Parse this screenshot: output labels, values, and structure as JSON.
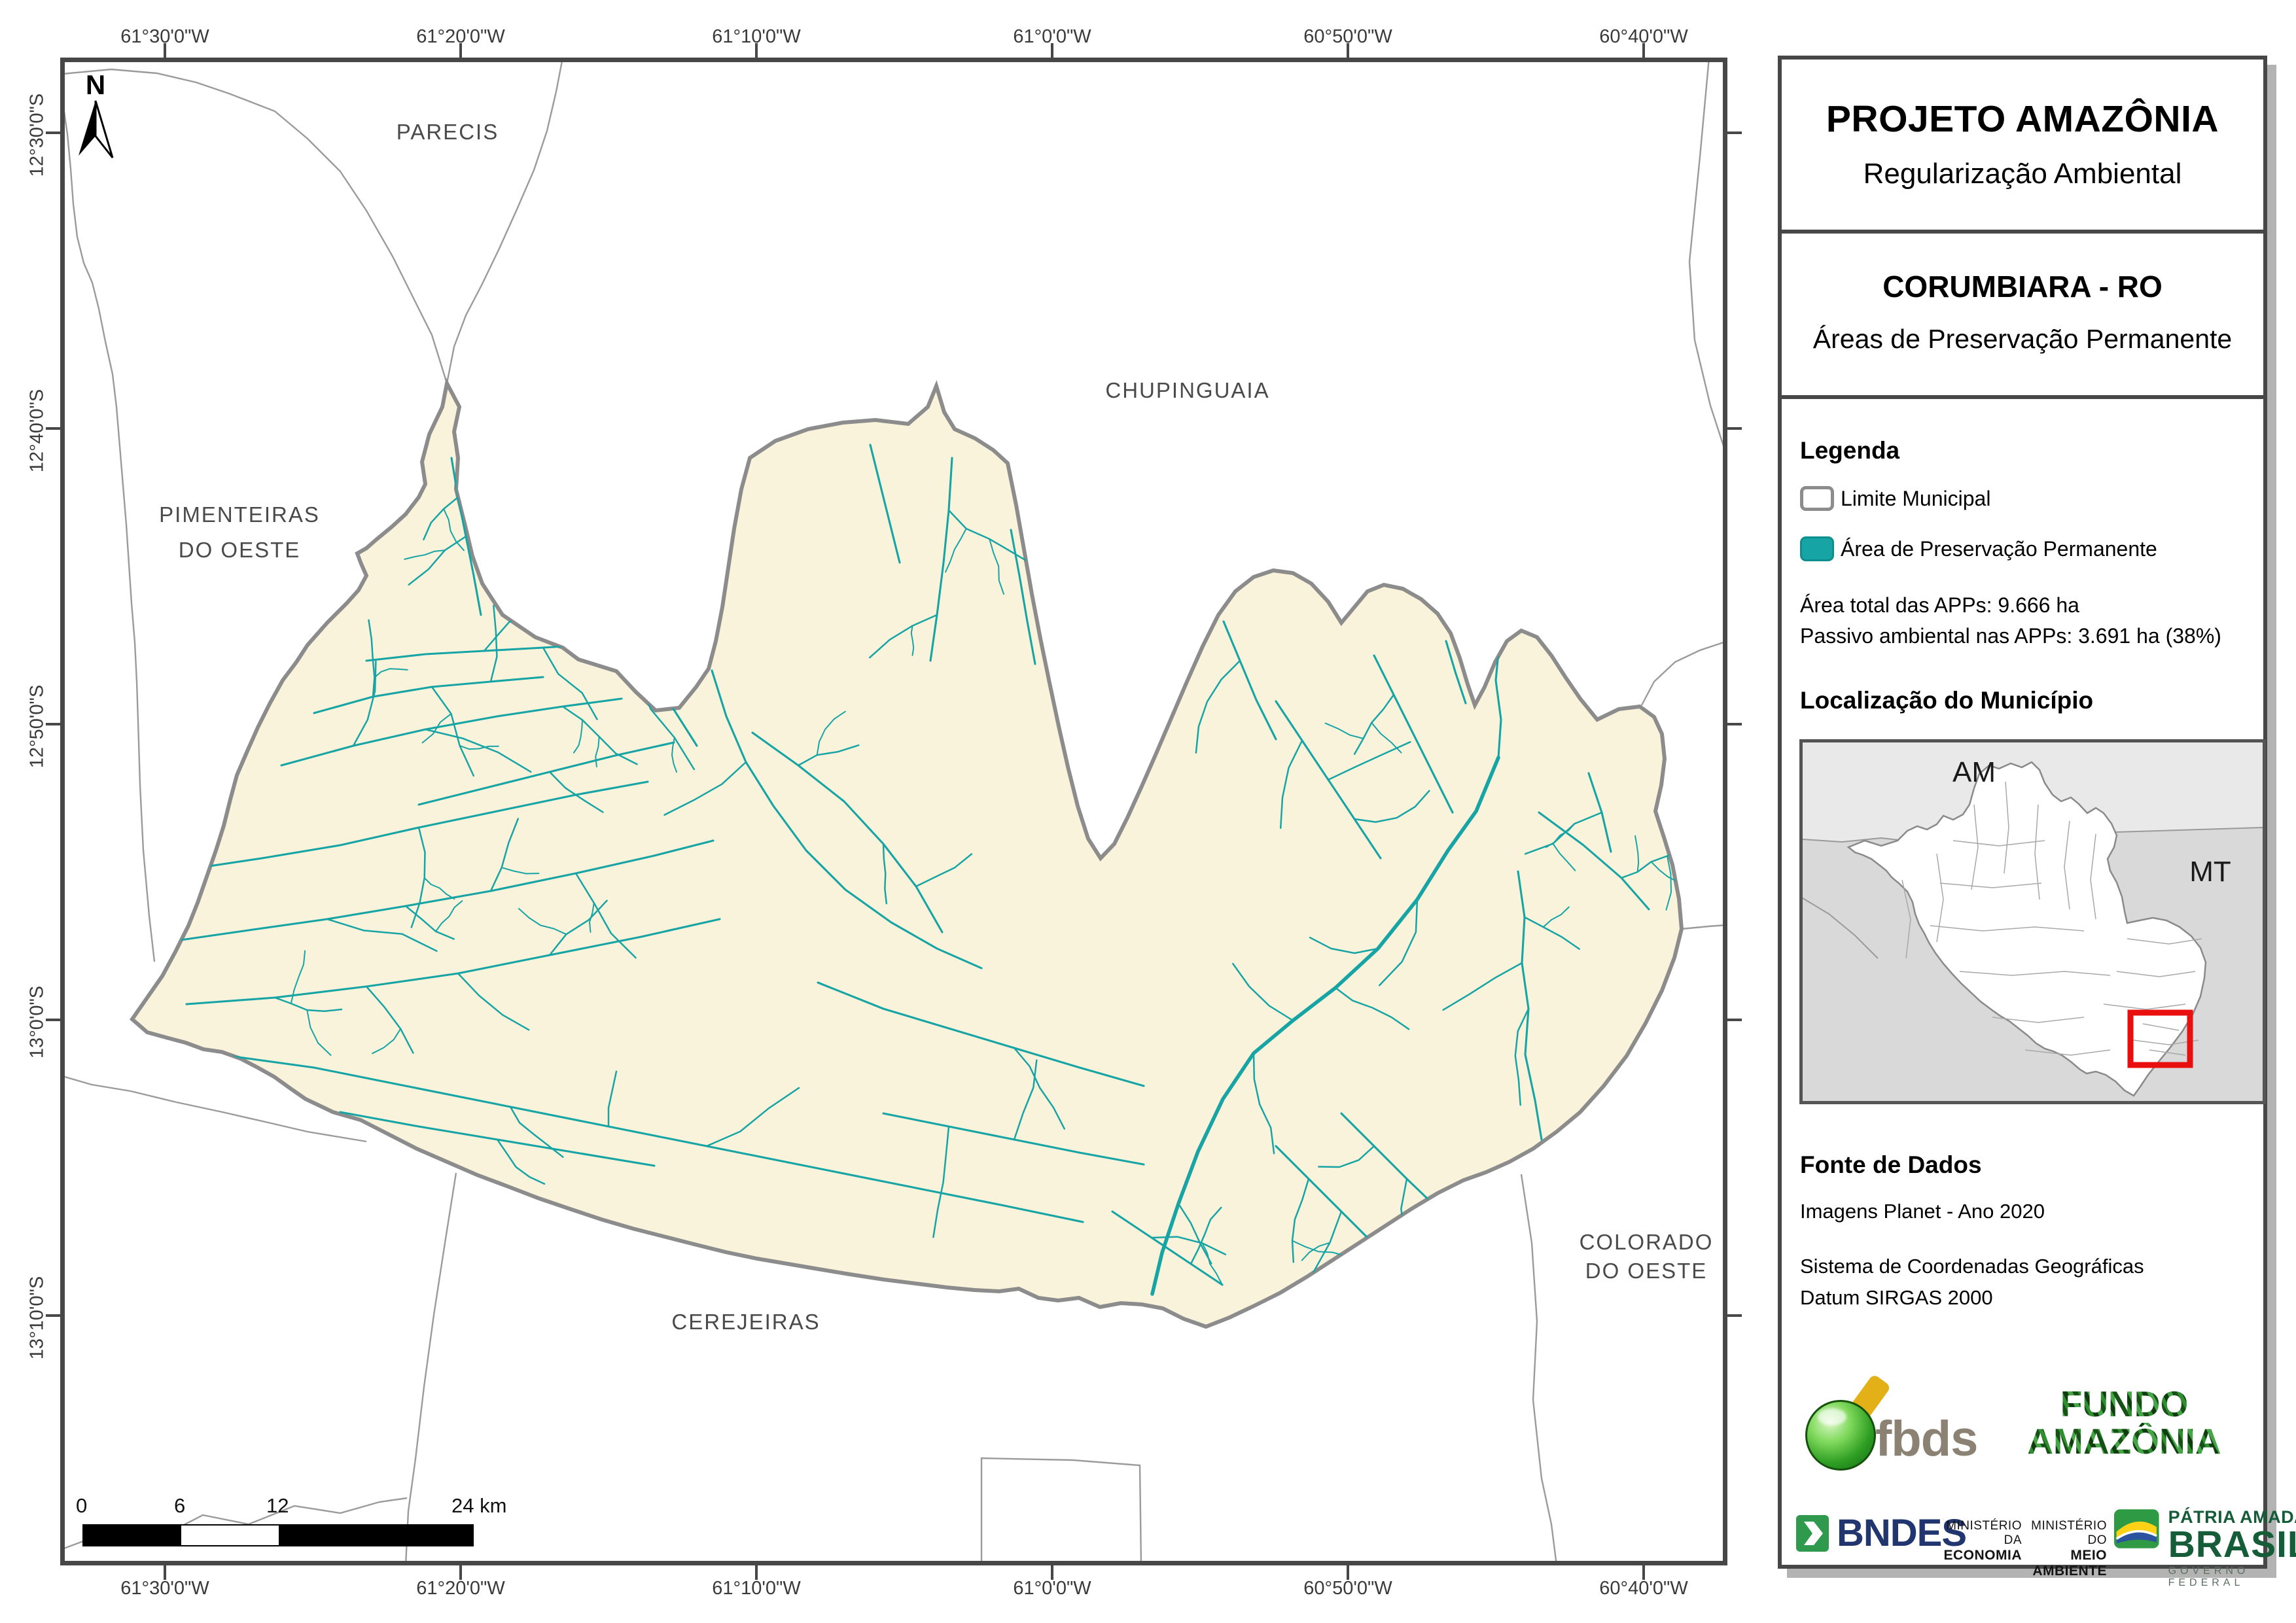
{
  "map": {
    "north_label": "N",
    "lon_labels": [
      "61°30'0\"W",
      "61°20'0\"W",
      "61°10'0\"W",
      "61°0'0\"W",
      "60°50'0\"W",
      "60°40'0\"W"
    ],
    "lat_labels": [
      "12°30'0\"S",
      "12°40'0\"S",
      "12°50'0\"S",
      "13°0'0\"S",
      "13°10'0\"S"
    ],
    "region_labels": {
      "parecis": "PARECIS",
      "pimenteiras_1": "PIMENTEIRAS",
      "pimenteiras_2": "DO OESTE",
      "chupinguaia": "CHUPINGUAIA",
      "colorado_1": "COLORADO",
      "colorado_2": "DO OESTE",
      "cerejeiras": "CEREJEIRAS"
    },
    "scalebar": {
      "t0": "0",
      "t6": "6",
      "t12": "12",
      "t24": "24 km"
    }
  },
  "panel": {
    "title": "PROJETO AMAZÔNIA",
    "subtitle": "Regularização Ambiental",
    "municipality": "CORUMBIARA - RO",
    "map_theme": "Áreas de Preservação Permanente",
    "legend": {
      "heading": "Legenda",
      "limite": "Limite Municipal",
      "app": "Área de Preservação Permanente"
    },
    "stats": {
      "total": "Área total das APPs: 9.666 ha",
      "passivo": "Passivo ambiental nas APPs: 3.691 ha (38%)"
    },
    "location": {
      "heading": "Localização do Município",
      "am": "AM",
      "mt": "MT"
    },
    "fonte": {
      "heading": "Fonte de Dados",
      "line1": "Imagens Planet - Ano 2020",
      "line2": "Sistema de Coordenadas Geográficas",
      "line3": "Datum SIRGAS 2000"
    },
    "logos": {
      "fbds": "fbds",
      "fundo_1": "FUNDO",
      "fundo_2": "AMAZÔNIA",
      "bndes": "BNDES",
      "min1_1": "MINISTÉRIO DA",
      "min1_2": "ECONOMIA",
      "min2_1": "MINISTÉRIO DO",
      "min2_2": "MEIO AMBIENTE",
      "gov_1": "PÁTRIA AMADA",
      "gov_2": "BRASIL",
      "gov_3": "GOVERNO FEDERAL"
    }
  },
  "colors": {
    "app_teal": "#16A4A4",
    "municipality_fill": "#FAF3DC",
    "municipality_border": "#8C8C8C",
    "neighbor_line": "#9B9B9B",
    "frame_dark": "#474747",
    "highlight_red": "#E90F0F"
  }
}
